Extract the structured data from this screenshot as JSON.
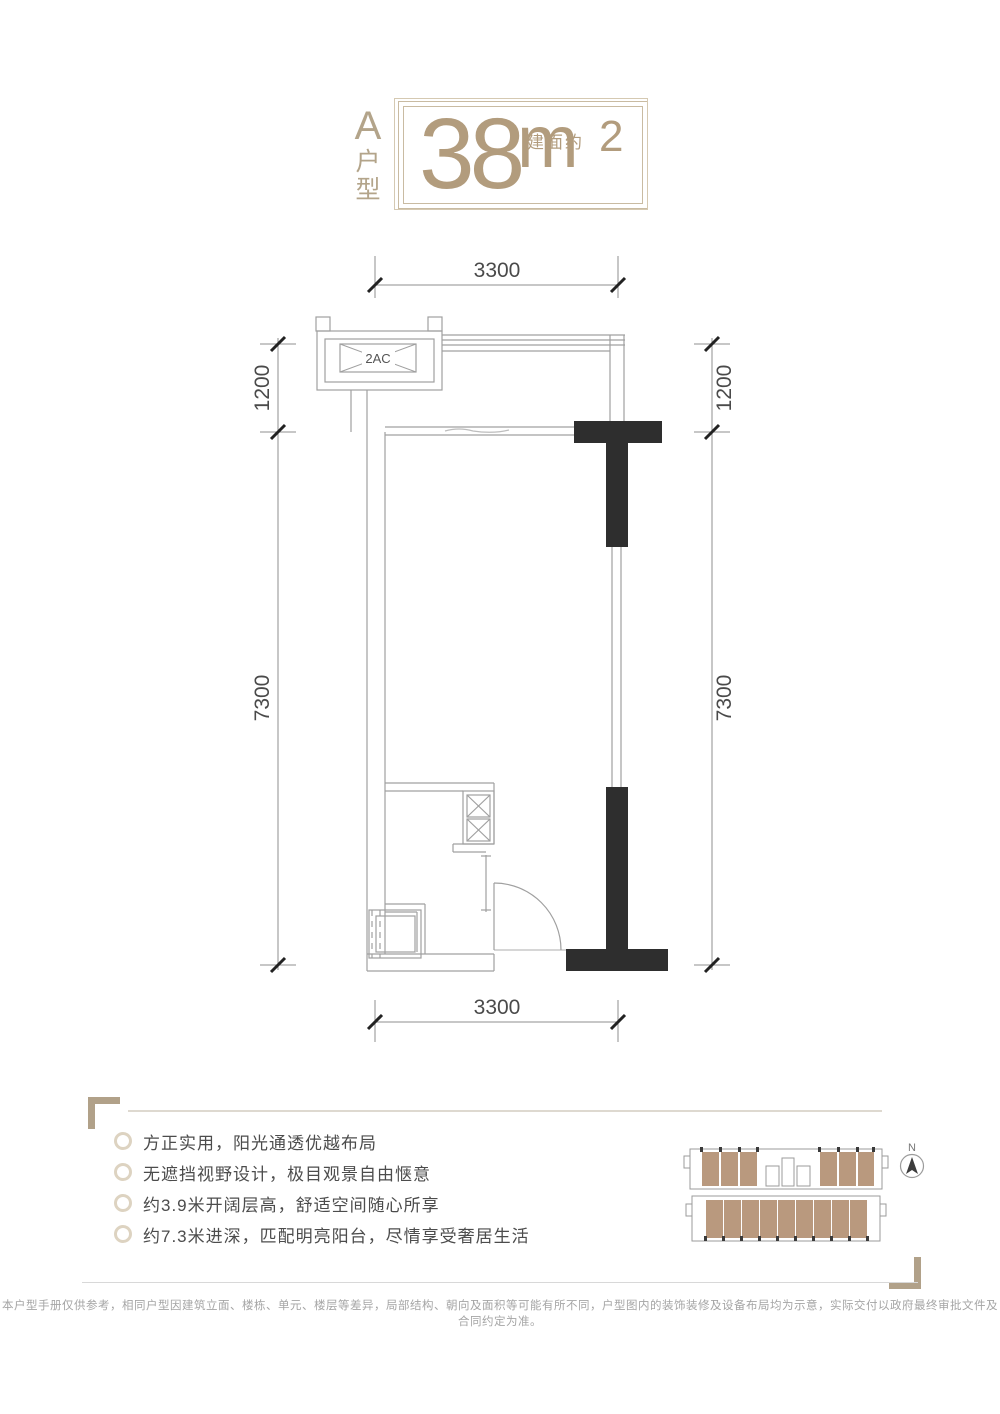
{
  "title": {
    "unit_letter": "A",
    "unit_type_chars": [
      "户",
      "型"
    ],
    "area_number": "38",
    "area_prefix": "建面约",
    "area_unit": "m",
    "area_exponent": "2"
  },
  "floor_plan": {
    "dim_top": "3300",
    "dim_bottom": "3300",
    "dim_left_upper": "1200",
    "dim_left_lower": "7300",
    "dim_right_upper": "1200",
    "dim_right_lower": "7300",
    "ac_label": "2AC"
  },
  "features": {
    "items": [
      "方正实用，阳光通透优越布局",
      "无遮挡视野设计，极目观景自由惬意",
      "约3.9米开阔层高，舒适空间随心所享",
      "约7.3米进深，匹配明亮阳台，尽情享受奢居生活"
    ]
  },
  "overview": {
    "north_label": "N"
  },
  "disclaimer": "本户型手册仅供参考，相同户型因建筑立面、楼栋、单元、楼层等差异，局部结构、朝向及面积等可能有所不同，户型图内的装饰装修及设备布局均为示意，实际交付以政府最终审批文件及合同约定为准。",
  "colors": {
    "tan": "#b29c7d",
    "wall_black": "#2e2e2e",
    "unit_brown": "#b08b6d",
    "line_gray": "#a0a0a0"
  }
}
